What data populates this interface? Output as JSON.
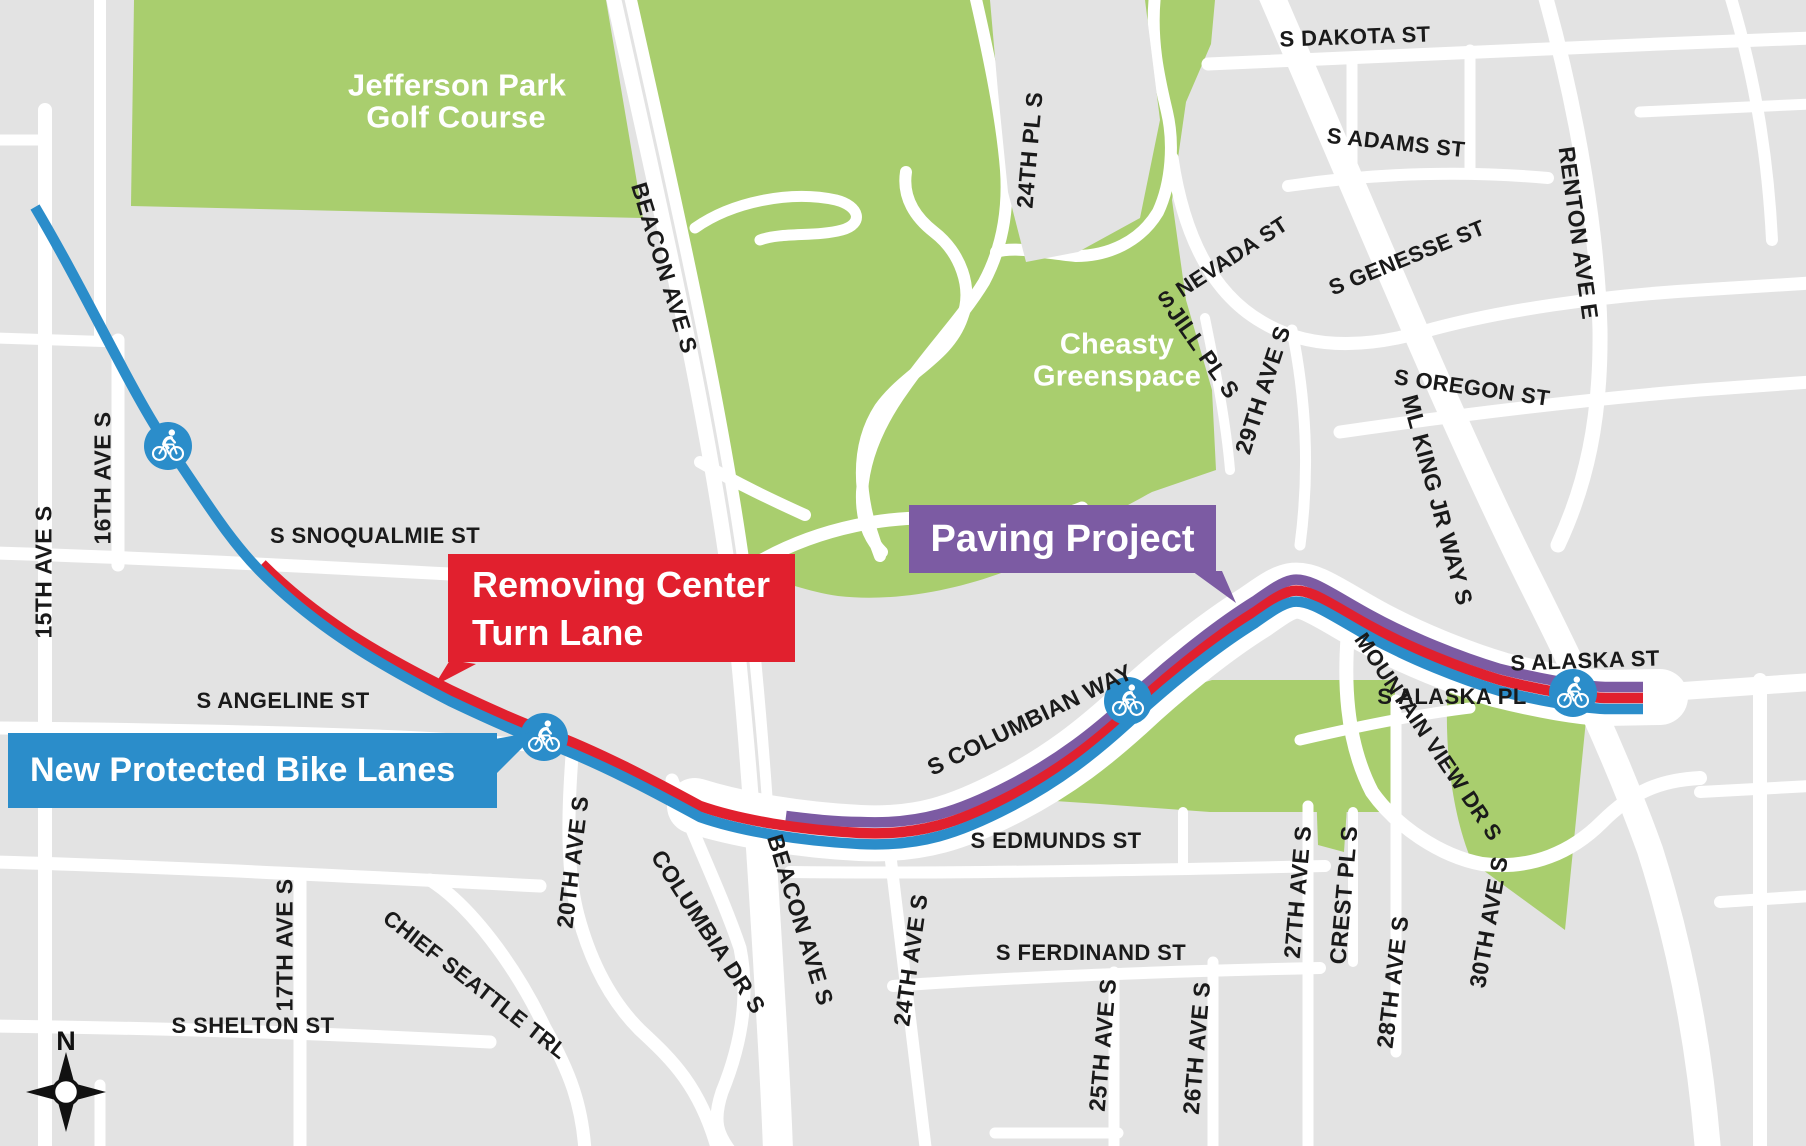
{
  "map": {
    "colors": {
      "background": "#e3e3e3",
      "street": "#ffffff",
      "park_green": "#a9ce6e",
      "route_new_bike_lanes": "#2b8dca",
      "route_removing_turn_lane": "#e1202e",
      "route_paving_project": "#7c5ba3",
      "label_dark": "#1a1a1a",
      "label_light": "#ffffff"
    },
    "callouts": {
      "paving": {
        "label": "Paving Project",
        "color": "#7c5ba3"
      },
      "removing": {
        "line1": "Removing Center",
        "line2": "Turn Lane",
        "color": "#e1202e"
      },
      "bike_lanes": {
        "label": "New Protected Bike Lanes",
        "color": "#2b8dca"
      }
    },
    "compass": {
      "label": "N"
    },
    "markers": [
      {
        "name": "bike-route-marker",
        "x": 168,
        "y": 446
      },
      {
        "name": "bike-route-marker",
        "x": 544,
        "y": 737
      },
      {
        "name": "bike-route-marker",
        "x": 1128,
        "y": 701
      },
      {
        "name": "bike-route-marker",
        "x": 1573,
        "y": 693
      }
    ],
    "area_labels": [
      {
        "id": "golf-line1",
        "text": "Jefferson Park",
        "x": 457,
        "y": 85,
        "rot": 0,
        "size": 31,
        "tone": "light"
      },
      {
        "id": "golf-line2",
        "text": "Golf Course",
        "x": 456,
        "y": 117,
        "rot": 0,
        "size": 31,
        "tone": "light"
      },
      {
        "id": "cheasty-line1",
        "text": "Cheasty",
        "x": 1117,
        "y": 345,
        "rot": 0,
        "size": 29,
        "tone": "light"
      },
      {
        "id": "cheasty-line2",
        "text": "Greenspace",
        "x": 1117,
        "y": 377,
        "rot": 0,
        "size": 29,
        "tone": "light"
      }
    ],
    "street_labels": [
      {
        "id": "s-snoqualmie-st",
        "text": "S SNOQUALMIE ST",
        "x": 375,
        "y": 536,
        "rot": 0,
        "size": 22
      },
      {
        "id": "15th-ave-s",
        "text": "15TH AVE S",
        "x": 44,
        "y": 572,
        "rot": -90,
        "size": 23
      },
      {
        "id": "16th-ave-s",
        "text": "16TH AVE S",
        "x": 103,
        "y": 478,
        "rot": -90,
        "size": 23
      },
      {
        "id": "s-angeline-st",
        "text": "S ANGELINE ST",
        "x": 283,
        "y": 701,
        "rot": 0,
        "size": 22
      },
      {
        "id": "17th-ave-s",
        "text": "17TH AVE S",
        "x": 285,
        "y": 945,
        "rot": -90,
        "size": 23
      },
      {
        "id": "s-shelton-st",
        "text": "S SHELTON ST",
        "x": 253,
        "y": 1026,
        "rot": 0,
        "size": 22
      },
      {
        "id": "chief-seattle-trl",
        "text": "CHIEF SEATTLE TRL",
        "x": 475,
        "y": 985,
        "rot": 38,
        "size": 22
      },
      {
        "id": "20th-ave-s",
        "text": "20TH AVE S",
        "x": 573,
        "y": 862,
        "rot": -83,
        "size": 23
      },
      {
        "id": "columbia-dr-s",
        "text": "COLUMBIA DR S",
        "x": 708,
        "y": 932,
        "rot": 57,
        "size": 23
      },
      {
        "id": "beacon-ave-s-north",
        "text": "BEACON AVE S",
        "x": 664,
        "y": 268,
        "rot": 73,
        "size": 23
      },
      {
        "id": "beacon-ave-s-south",
        "text": "BEACON AVE S",
        "x": 800,
        "y": 920,
        "rot": 73,
        "size": 23
      },
      {
        "id": "24th-pl-s",
        "text": "24TH PL S",
        "x": 1030,
        "y": 150,
        "rot": -85,
        "size": 23
      },
      {
        "id": "s-columbian-way",
        "text": "S COLUMBIAN WAY",
        "x": 1030,
        "y": 720,
        "rot": -26,
        "size": 23
      },
      {
        "id": "s-edmunds-st",
        "text": "S EDMUNDS ST",
        "x": 1056,
        "y": 841,
        "rot": 0,
        "size": 22
      },
      {
        "id": "24th-ave-s",
        "text": "24TH AVE S",
        "x": 911,
        "y": 960,
        "rot": -82,
        "size": 23
      },
      {
        "id": "s-ferdinand-st",
        "text": "S FERDINAND ST",
        "x": 1091,
        "y": 953,
        "rot": 0,
        "size": 22
      },
      {
        "id": "25th-ave-s",
        "text": "25TH AVE S",
        "x": 1103,
        "y": 1045,
        "rot": -85,
        "size": 23
      },
      {
        "id": "26th-ave-s",
        "text": "26TH AVE S",
        "x": 1197,
        "y": 1048,
        "rot": -85,
        "size": 23
      },
      {
        "id": "27th-ave-s",
        "text": "27TH AVE S",
        "x": 1298,
        "y": 892,
        "rot": -85,
        "size": 23
      },
      {
        "id": "crest-pl-s",
        "text": "CREST PL S",
        "x": 1344,
        "y": 895,
        "rot": -85,
        "size": 23
      },
      {
        "id": "28th-ave-s",
        "text": "28TH AVE S",
        "x": 1393,
        "y": 982,
        "rot": -83,
        "size": 23
      },
      {
        "id": "30th-ave-s",
        "text": "30TH AVE S",
        "x": 1489,
        "y": 922,
        "rot": -80,
        "size": 23
      },
      {
        "id": "mountain-view-dr-s",
        "text": "MOUNTAIN VIEW DR S",
        "x": 1428,
        "y": 737,
        "rot": 56,
        "size": 22
      },
      {
        "id": "s-alaska-pl",
        "text": "S ALASKA PL",
        "x": 1452,
        "y": 697,
        "rot": 0,
        "size": 22
      },
      {
        "id": "s-alaska-st",
        "text": "S ALASKA ST",
        "x": 1585,
        "y": 661,
        "rot": -2,
        "size": 22
      },
      {
        "id": "s-dakota-st",
        "text": "S DAKOTA ST",
        "x": 1355,
        "y": 37,
        "rot": -2,
        "size": 22
      },
      {
        "id": "s-adams-st",
        "text": "S ADAMS ST",
        "x": 1396,
        "y": 143,
        "rot": 6,
        "size": 22
      },
      {
        "id": "renton-ave-e",
        "text": "RENTON AVE E",
        "x": 1578,
        "y": 233,
        "rot": 82,
        "size": 23
      },
      {
        "id": "s-nevada-st",
        "text": "S NEVADA ST",
        "x": 1223,
        "y": 263,
        "rot": -33,
        "size": 22
      },
      {
        "id": "s-genesse-st",
        "text": "S GENESSE ST",
        "x": 1407,
        "y": 258,
        "rot": -22,
        "size": 22
      },
      {
        "id": "jill-pl-s",
        "text": "JILL PL S",
        "x": 1203,
        "y": 352,
        "rot": 55,
        "size": 23
      },
      {
        "id": "29th-ave-s",
        "text": "29TH AVE S",
        "x": 1263,
        "y": 390,
        "rot": -72,
        "size": 23
      },
      {
        "id": "s-oregon-st",
        "text": "S OREGON ST",
        "x": 1472,
        "y": 388,
        "rot": 8,
        "size": 22
      },
      {
        "id": "ml-king-jr-way-s",
        "text": "ML KING JR WAY S",
        "x": 1437,
        "y": 500,
        "rot": 75,
        "size": 23
      }
    ]
  }
}
